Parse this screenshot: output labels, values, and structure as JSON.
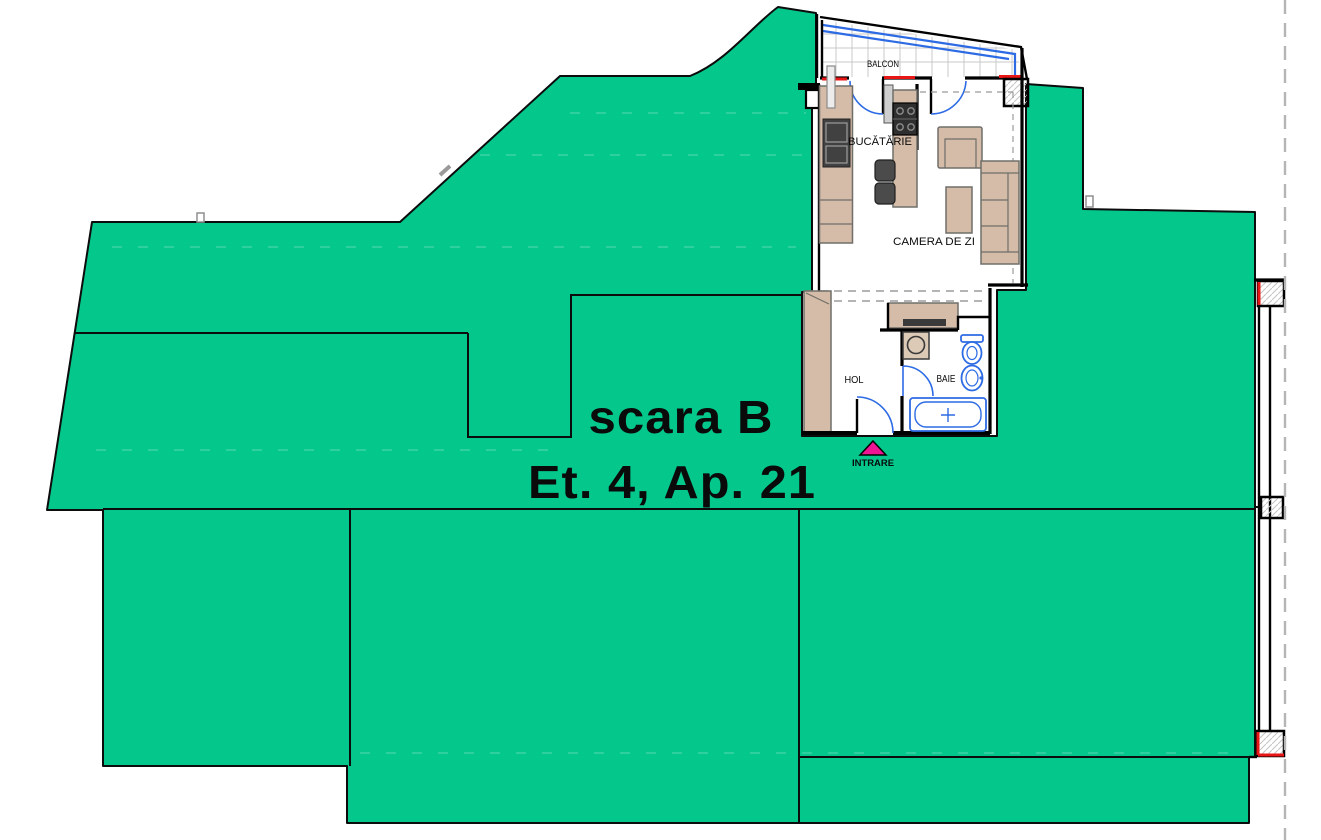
{
  "plan": {
    "apartment_title": {
      "line1": "scara B",
      "line2": "Et. 4, Ap. 21"
    },
    "rooms": [
      {
        "id": "balcony",
        "label": "BALCON"
      },
      {
        "id": "kitchen",
        "label": "BUCĂTĂRIE"
      },
      {
        "id": "living-room",
        "label": "CAMERA DE ZI"
      },
      {
        "id": "hallway",
        "label": "HOL"
      },
      {
        "id": "bathroom",
        "label": "BAIE"
      }
    ],
    "entrance": {
      "label": "INTRARE",
      "icon": "entrance-arrow-icon"
    },
    "colors": {
      "mask_green": "#04C78C",
      "furniture_tan": "#D5BCA8",
      "fixture_blue": "#2D6BE4",
      "window_red": "#E81616",
      "entrance_pink": "#EE1493",
      "wall_black": "#000000",
      "boundary_dash_gray": "#B5B5B5"
    }
  }
}
